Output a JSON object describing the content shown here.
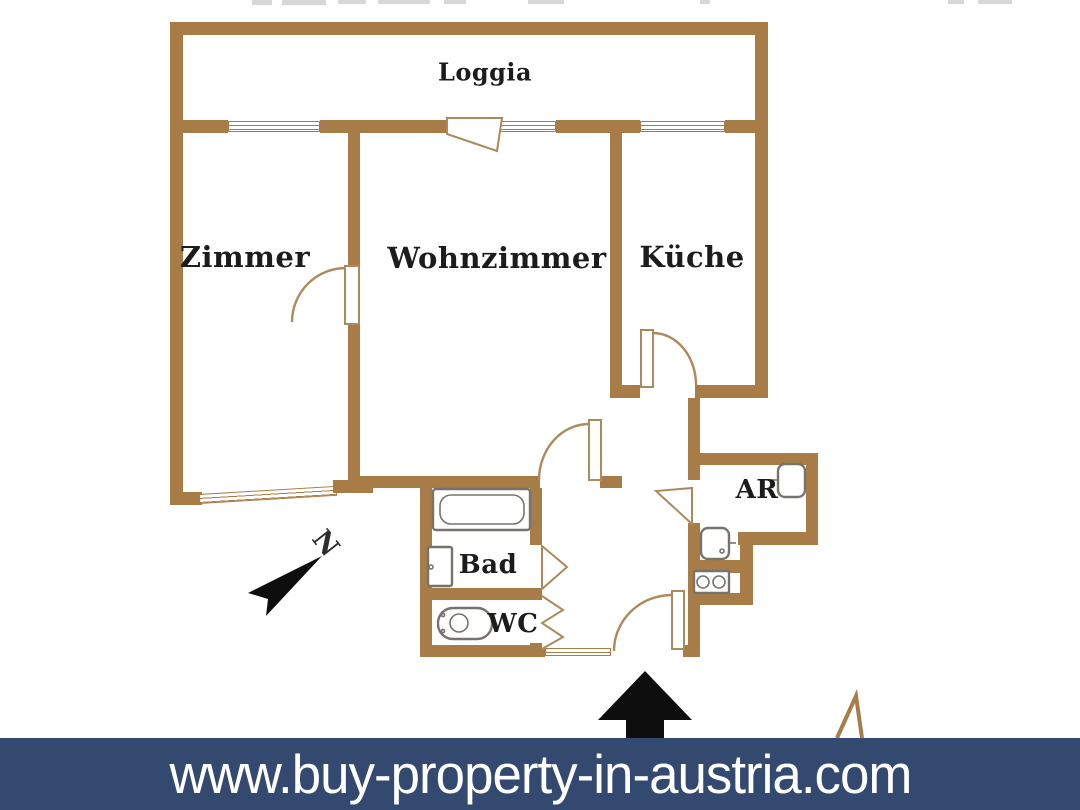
{
  "plan": {
    "rooms": {
      "loggia": "Loggia",
      "zimmer": "Zimmer",
      "wohnzimmer": "Wohnzimmer",
      "kueche": "Küche",
      "bad": "Bad",
      "wc": "WC",
      "ar": "AR"
    },
    "compass": {
      "north_label": "N"
    }
  },
  "banner": {
    "url_text": "www.buy-property-in-austria.com"
  },
  "colors": {
    "wall": "#a87c46",
    "door_outline": "#ad8a5c",
    "fixture_outline": "#77736c",
    "label_text": "#1c1c1c",
    "arrow_black": "#0e0e0e",
    "banner_bg": "#334970",
    "banner_text": "#ffffff",
    "background": "#ffffff"
  }
}
